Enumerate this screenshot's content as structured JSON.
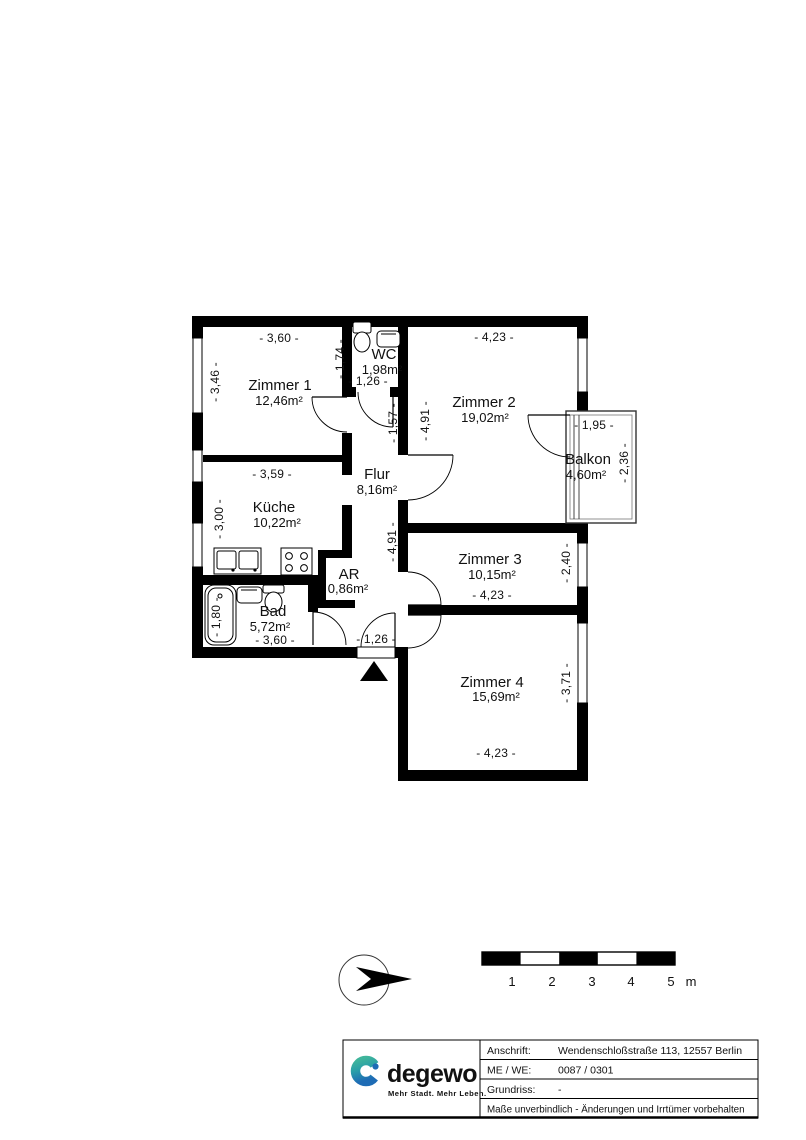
{
  "plan": {
    "rooms": [
      {
        "name": "Zimmer 1",
        "area": "12,46m²"
      },
      {
        "name": "WC",
        "area": "1,98m²"
      },
      {
        "name": "Zimmer 2",
        "area": "19,02m²"
      },
      {
        "name": "Küche",
        "area": "10,22m²"
      },
      {
        "name": "Flur",
        "area": "8,16m²"
      },
      {
        "name": "Balkon",
        "area": "4,60m²"
      },
      {
        "name": "Zimmer 3",
        "area": "10,15m²"
      },
      {
        "name": "AR",
        "area": "0,86m²"
      },
      {
        "name": "Bad",
        "area": "5,72m²"
      },
      {
        "name": "Zimmer 4",
        "area": "15,69m²"
      }
    ],
    "dims": {
      "zimmer1_width": "- 3,60 -",
      "zimmer1_depth": "- 3,46 -",
      "wc_depth": "- 1,74 -",
      "wc_width": "- 1,26 -",
      "flur_upper": "- 1,57 -",
      "zimmer2_width": "- 4,23 -",
      "zimmer2_depth": "- 4,91 -",
      "kueche_width": "- 3,59 -",
      "kueche_depth": "- 3,00 -",
      "balkon_width": "- 1,95 -",
      "balkon_depth": "- 2,36 -",
      "flur_length": "- 4,91 -",
      "zimmer3_width": "- 4,23 -",
      "zimmer3_depth": "- 2,40 -",
      "bad_width": "- 3,60 -",
      "bad_tub": "- 1,80 -",
      "entry_width": "- 1,26 -",
      "zimmer4_width": "- 4,23 -",
      "zimmer4_depth": "- 3,71 -"
    }
  },
  "scalebar": {
    "labels": [
      "1",
      "2",
      "3",
      "4",
      "5"
    ],
    "unit": "m"
  },
  "titleblock": {
    "brand": "degewo",
    "tagline": "Mehr Stadt. Mehr Leben.",
    "rows": [
      {
        "label": "Anschrift:",
        "value": "Wendenschloßstraße 113, 12557 Berlin"
      },
      {
        "label": "ME / WE:",
        "value": "0087 / 0301"
      },
      {
        "label": "Grundriss:",
        "value": "-"
      }
    ],
    "disclaimer": "Maße unverbindlich - Änderungen und Irrtümer vorbehalten"
  },
  "colors": {
    "ink": "#000000",
    "brand_blue": "#1e6cb5",
    "brand_teal": "#3fb59b",
    "brand_green": "#55a53f"
  }
}
